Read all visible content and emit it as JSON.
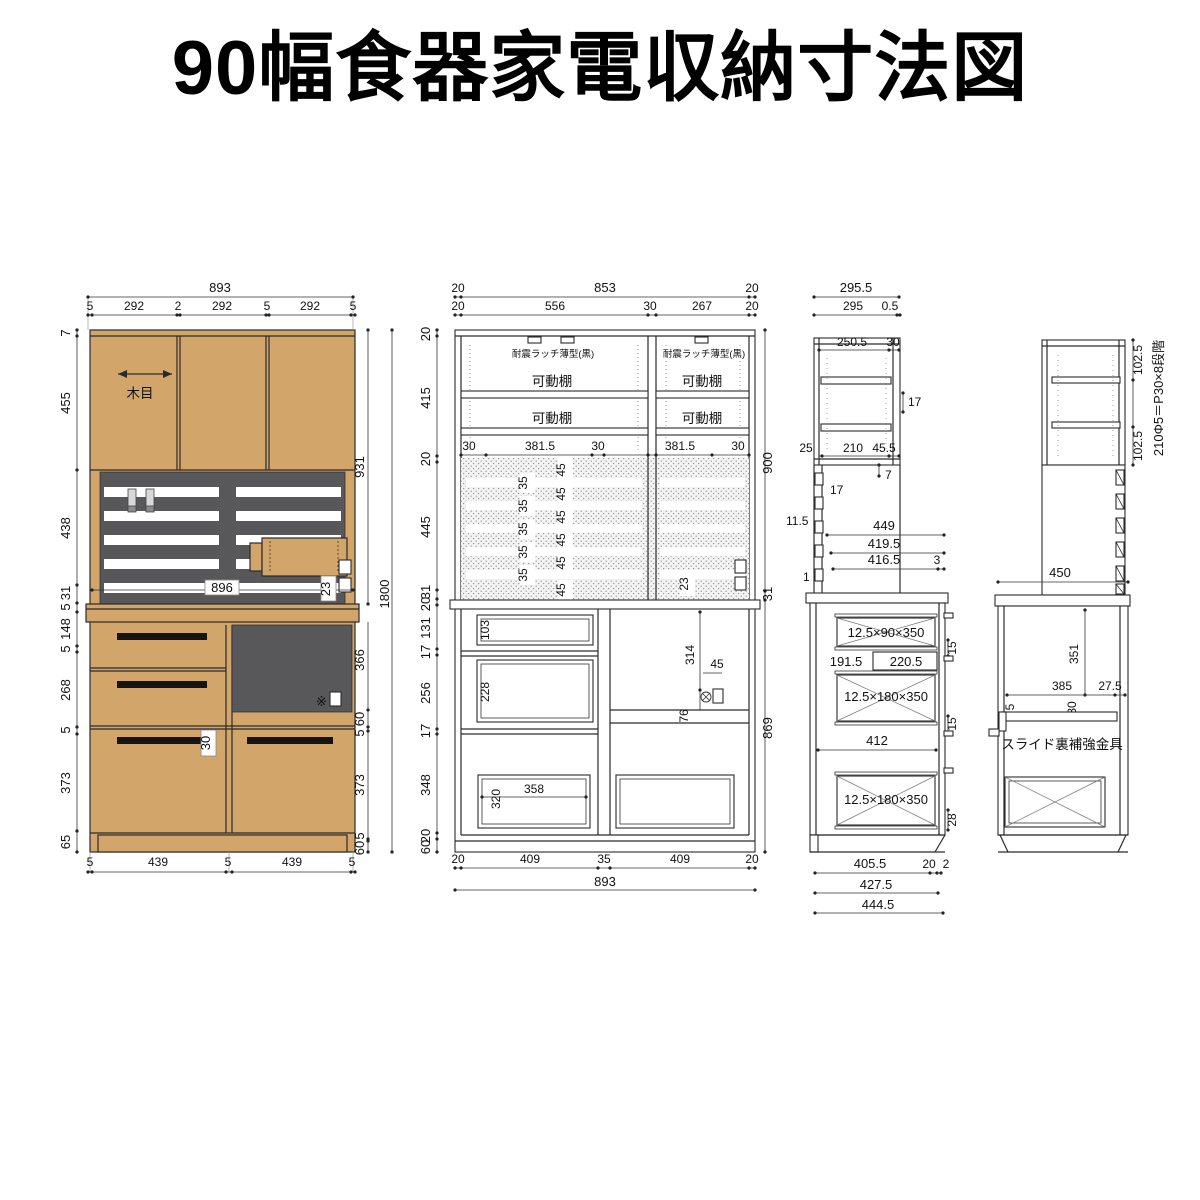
{
  "title": "90幅食器家電収納寸法図",
  "colors": {
    "wood": "#D2A66B",
    "dark_gray": "#58585A",
    "line": "#1a1a1a"
  },
  "front_view": {
    "top": [
      "893",
      "5",
      "292",
      "2",
      "292",
      "5",
      "292",
      "5"
    ],
    "left": [
      "7",
      "455",
      "438",
      "31",
      "5",
      "148",
      "5",
      "268",
      "5",
      "373",
      "65"
    ],
    "right": [
      "931",
      "1800",
      "366",
      "60",
      "5",
      "373",
      "5",
      "60"
    ],
    "bottom": [
      "5",
      "439",
      "5",
      "439",
      "5"
    ],
    "labels": {
      "wood_grain": "木目",
      "counter_width": "896",
      "clearance23": "23",
      "handle30": "30"
    }
  },
  "internal_view": {
    "top": [
      "20",
      "853",
      "20"
    ],
    "top2": [
      "20",
      "556",
      "30",
      "267",
      "20"
    ],
    "left": [
      "20",
      "415",
      "20",
      "445",
      "31",
      "20",
      "131",
      "17",
      "256",
      "17",
      "348",
      "20",
      "60"
    ],
    "right": [
      "900",
      "31",
      "869"
    ],
    "latch_label": "耐震ラッチ薄型(黒)",
    "shelf_label": "可動棚",
    "shelf_row": [
      "30",
      "381.5",
      "30",
      "381.5",
      "30"
    ],
    "slat_gap": "35",
    "slat_height": "45",
    "clearance23": "23",
    "inner": [
      "103",
      "228",
      "314",
      "45",
      "76",
      "320",
      "358"
    ],
    "bottom": [
      "20",
      "409",
      "35",
      "409",
      "20",
      "893"
    ]
  },
  "side_view": {
    "top": [
      "295.5",
      "295",
      "0.5"
    ],
    "upper": [
      "250.5",
      "30",
      "17",
      "25",
      "210",
      "45.5",
      "7"
    ],
    "left": [
      "17",
      "11.5",
      "1"
    ],
    "mid": [
      "449",
      "419.5",
      "416.5",
      "3"
    ],
    "sizes": {
      "top": "12.5×90×350",
      "mid": "12.5×180×350",
      "bottom": "12.5×180×350"
    },
    "inner": [
      "15",
      "191.5",
      "220.5",
      "15",
      "412",
      "28"
    ],
    "bottom": [
      "405.5",
      "20",
      "2",
      "427.5",
      "444.5"
    ]
  },
  "rear_view": {
    "right": [
      "102.5",
      "210Φ5＝P30×8段階",
      "102.5"
    ],
    "width": "450",
    "inner": [
      "351",
      "385",
      "27.5",
      "5",
      "30"
    ],
    "bracket": "スライド裏補強金具"
  }
}
